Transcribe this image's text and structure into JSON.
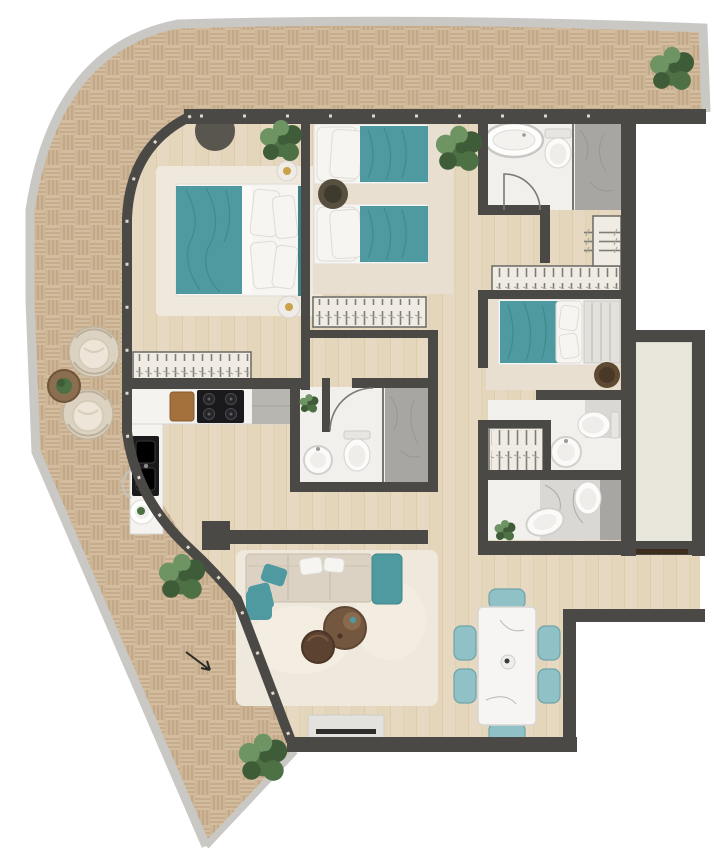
{
  "title": "apartment-floor-plan",
  "colors": {
    "wall": "#4a4946",
    "rim": "#c9c8c5",
    "deck": "#d3bd9e",
    "deckDark": "#c6ae8c",
    "deckLine": "#b89e7e",
    "wood": "#e7d9c1",
    "woodLine": "#ddcbac",
    "bathFloor": "#f2f0ed",
    "marble": "#a7a6a2",
    "marbleLight": "#d9d8d4",
    "carpet": "#e8dfd0",
    "rug": "#efe9dd",
    "teal": "#4e9aa0",
    "tealDark": "#3e7f86",
    "tealLight": "#8fc1c7",
    "linen": "#f7f5f1",
    "sofa": "#dbd2c3",
    "brown": "#74573f",
    "brownDark": "#5c4331",
    "counter": "#f4f3f0",
    "appliance": "#1a1a1c",
    "cabinet": "#b8b6b1",
    "coreFill": "#e9e6db",
    "doorWood": "#3c2d1e",
    "gold": "#c9a24a",
    "wicker": "#dcd2c1",
    "plantDark": "#3f5c38",
    "plantMid": "#4e7045",
    "plantLight": "#6f9464"
  },
  "rooms": [
    {
      "name": "terrace",
      "floor": "timber-deck"
    },
    {
      "name": "master-bedroom",
      "floor": "carpet-rug"
    },
    {
      "name": "twin-bedroom",
      "floor": "carpet"
    },
    {
      "name": "third-bedroom",
      "floor": "carpet"
    },
    {
      "name": "bathroom-top",
      "fixtures": [
        "bathtub",
        "toilet",
        "marble-shower"
      ]
    },
    {
      "name": "bathroom-middle",
      "fixtures": [
        "round-sink",
        "toilet",
        "marble-shower",
        "plant"
      ]
    },
    {
      "name": "ensuite-bathroom",
      "fixtures": [
        "toilet",
        "round-sink",
        "closet"
      ]
    },
    {
      "name": "main-bathroom",
      "fixtures": [
        "double-sinks",
        "plant",
        "marble-wall"
      ]
    },
    {
      "name": "walk-in-wardrobe",
      "fixtures": [
        "hanging-rails"
      ]
    },
    {
      "name": "kitchen",
      "fixtures": [
        "cooktop",
        "cutting-board",
        "double-sink",
        "tall-cabinet"
      ]
    },
    {
      "name": "living-room",
      "fixtures": [
        "sofa",
        "teal-armchair",
        "coffee-tables",
        "tv-console",
        "rug"
      ]
    },
    {
      "name": "dining-area",
      "fixtures": [
        "marble-table",
        "six-teal-chairs"
      ]
    },
    {
      "name": "hallway",
      "fixtures": []
    },
    {
      "name": "entrance-corridor",
      "fixtures": [
        "entry-door"
      ]
    },
    {
      "name": "elevator-shaft",
      "fixtures": []
    }
  ],
  "outdoor_items": [
    "wicker-lounge-chairs",
    "side-table",
    "potted-plants"
  ]
}
